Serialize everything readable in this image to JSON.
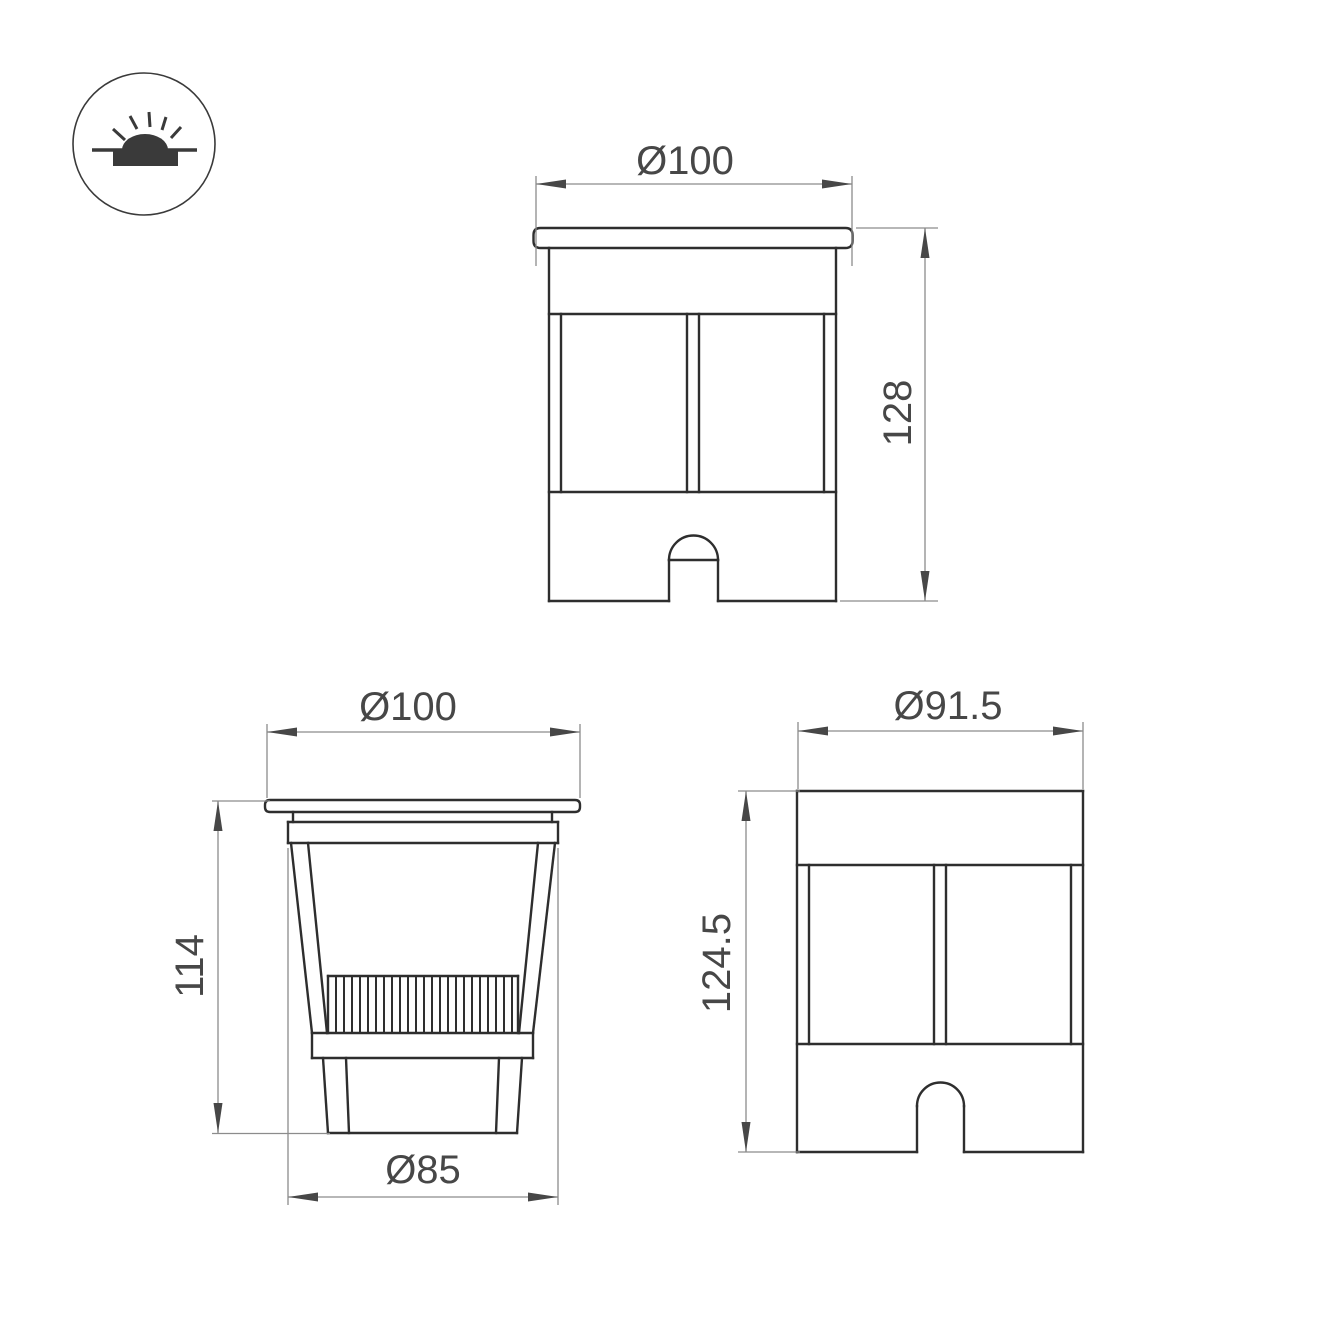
{
  "page": {
    "background": "#ffffff"
  },
  "colors": {
    "object_line": "#2e2e2e",
    "dimension_line": "#8c8c8c",
    "arrow": "#474747",
    "text": "#474747",
    "icon": "#3a3a3a"
  },
  "icon": {
    "name": "recessed-ground-light-icon"
  },
  "views": {
    "front": {
      "diameter_label": "Ø100",
      "height_label": "128"
    },
    "section": {
      "diameter_label": "Ø100",
      "height_label": "114",
      "bottom_diameter_label": "Ø85",
      "heatsink_fin_count": 23
    },
    "side": {
      "diameter_label": "Ø91.5",
      "height_label": "124.5"
    }
  }
}
